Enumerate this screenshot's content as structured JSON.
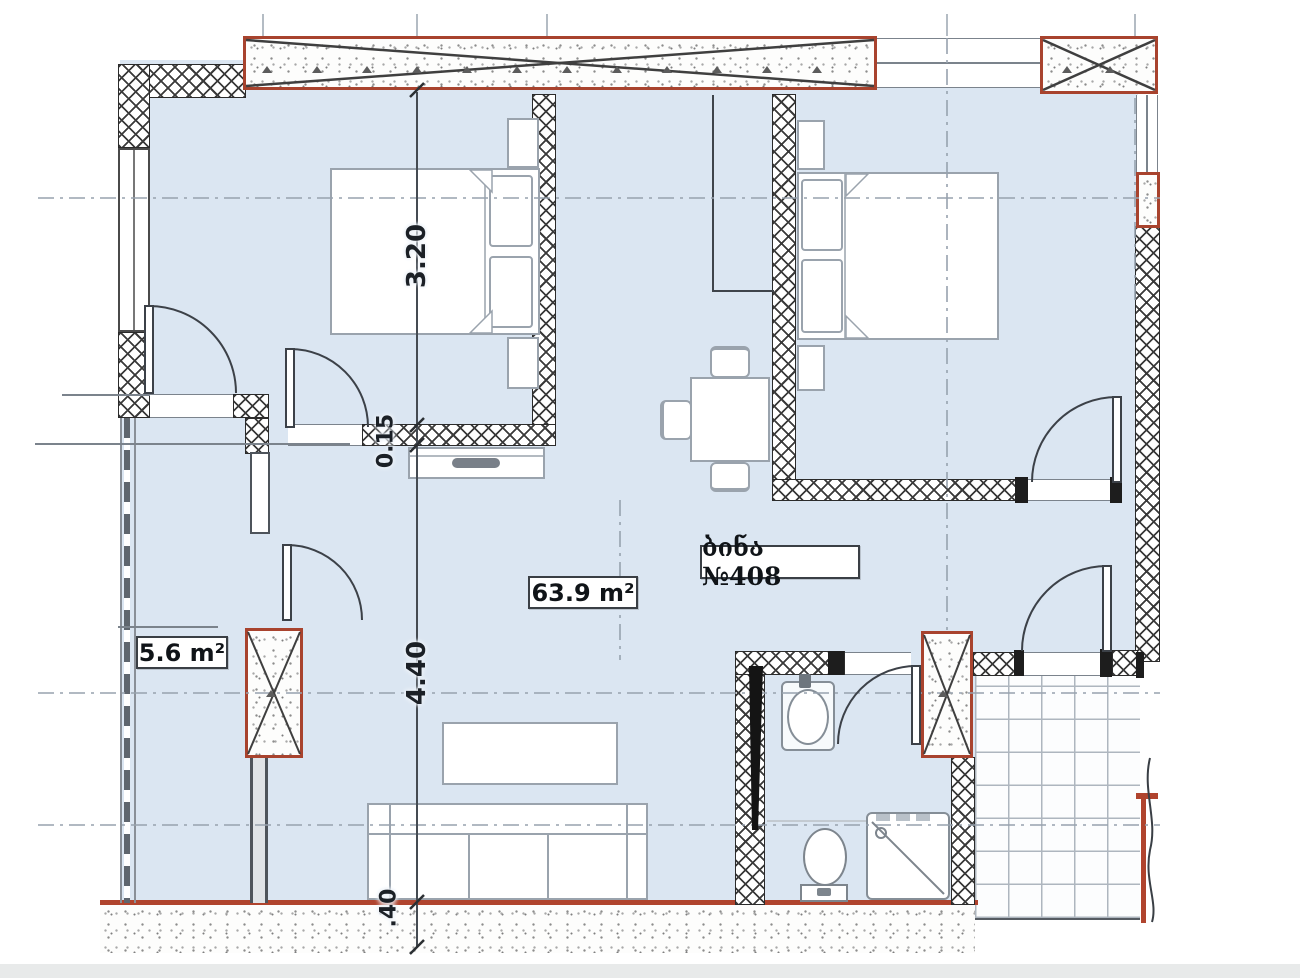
{
  "plan": {
    "apartment_label": "ბინა №408",
    "living_area_label": "63.9 m²",
    "small_room_area_label": "5.6 m²",
    "dimensions": {
      "bedroom_depth": "3.20",
      "interior_wall": "0.15",
      "living_depth": "4.40",
      "exterior_wall": ".40"
    },
    "colors": {
      "floor": "#dbe6f2",
      "structural_red": "#a8432e",
      "hatch": "#3a3a3a",
      "centerline": "#97a2ae",
      "furniture_line": "#9aa3ad",
      "tile_line": "#aeb6bf"
    }
  }
}
